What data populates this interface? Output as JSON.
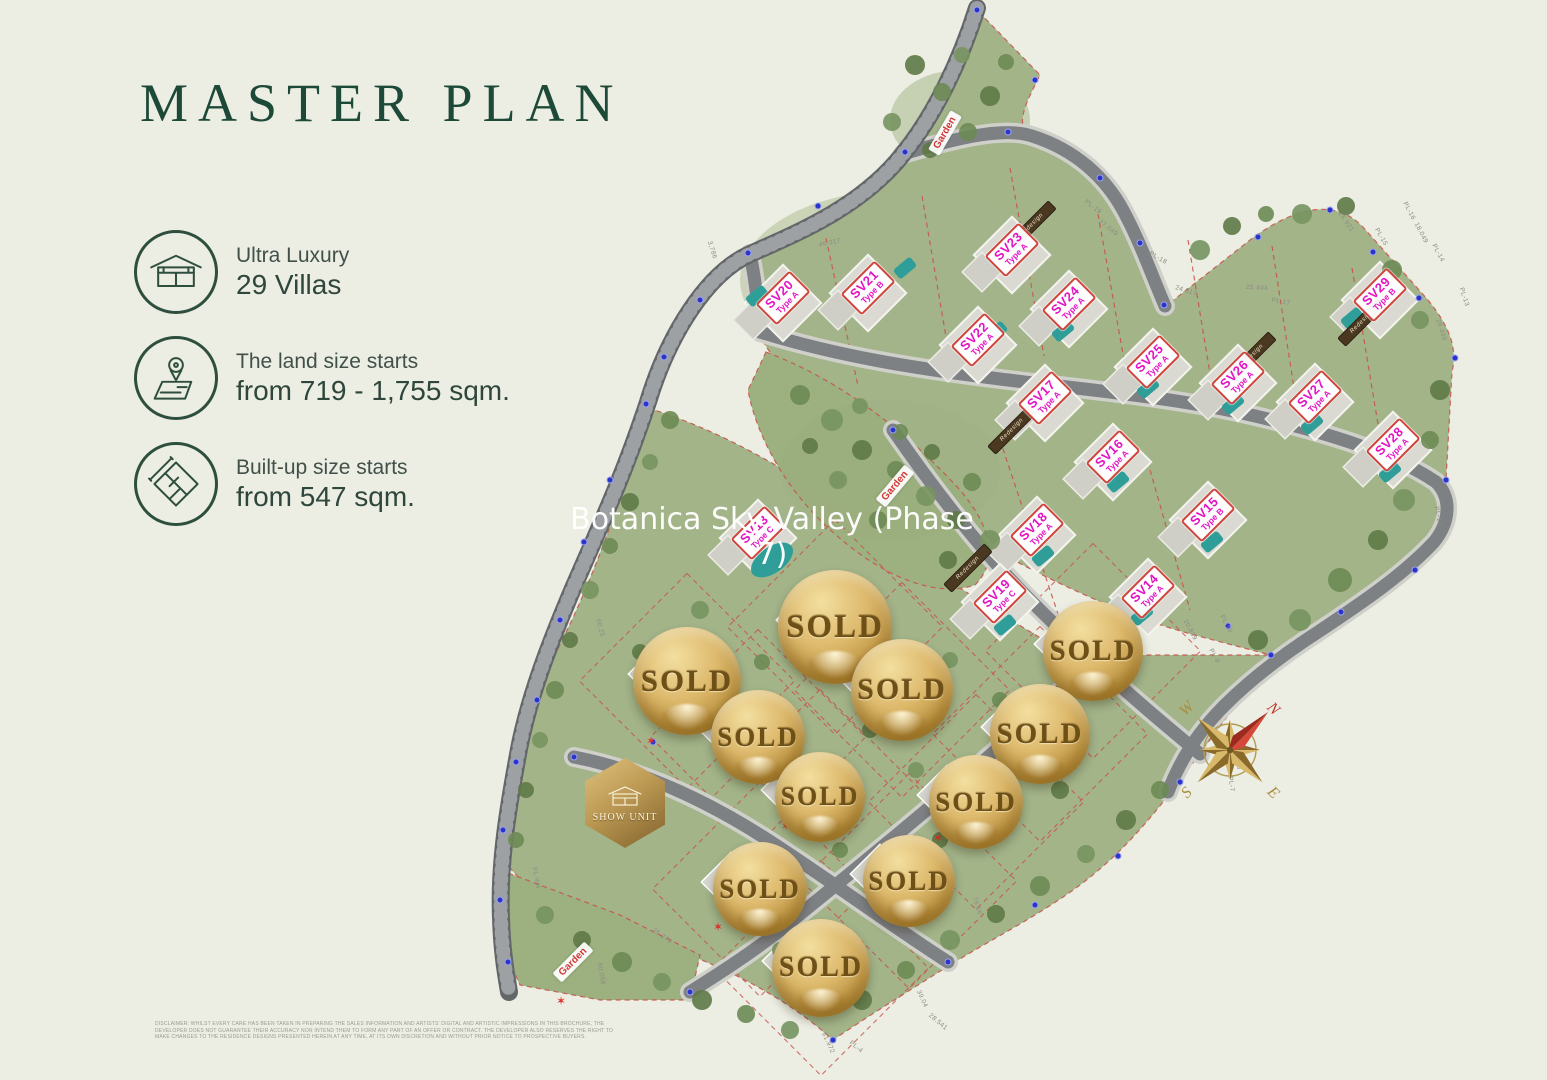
{
  "title": "MASTER PLAN",
  "colors": {
    "title_green": "#1d4a38",
    "villa_label_magenta": "#e414c4",
    "villa_label_border_red": "#d0453c",
    "sold_gold": "#caa24e",
    "garden_red": "#d23737",
    "terrain_green": "#a3b489",
    "background_beige": "#ecede3"
  },
  "legend": {
    "items": [
      {
        "icon": "villa-icon",
        "line1": "Ultra Luxury",
        "line2": "29 Villas"
      },
      {
        "icon": "land-size-icon",
        "line1": "The land size starts",
        "line2": "from 719 - 1,755 sqm."
      },
      {
        "icon": "built-up-icon",
        "line1": "Built-up size starts",
        "line2": "from 547 sqm."
      }
    ]
  },
  "watermark": {
    "line1": "Botanica Sky Valley (Phase",
    "line2": "7)"
  },
  "map": {
    "villa_labels": [
      {
        "id": "SV20",
        "type": "Type A",
        "x": 783,
        "y": 298,
        "rot": -45
      },
      {
        "id": "SV21",
        "type": "Type B",
        "x": 868,
        "y": 288,
        "rot": -45
      },
      {
        "id": "SV23",
        "type": "Type A",
        "x": 1012,
        "y": 250,
        "rot": -45
      },
      {
        "id": "SV22",
        "type": "Type A",
        "x": 978,
        "y": 340,
        "rot": -45
      },
      {
        "id": "SV24",
        "type": "Type A",
        "x": 1069,
        "y": 304,
        "rot": -45
      },
      {
        "id": "SV25",
        "type": "Type A",
        "x": 1153,
        "y": 362,
        "rot": -45
      },
      {
        "id": "SV26",
        "type": "Type A",
        "x": 1238,
        "y": 378,
        "rot": -45
      },
      {
        "id": "SV27",
        "type": "Type A",
        "x": 1315,
        "y": 397,
        "rot": -45
      },
      {
        "id": "SV28",
        "type": "Type A",
        "x": 1393,
        "y": 445,
        "rot": -45
      },
      {
        "id": "SV29",
        "type": "Type B",
        "x": 1380,
        "y": 295,
        "rot": -45
      },
      {
        "id": "SV17",
        "type": "Type A",
        "x": 1045,
        "y": 398,
        "rot": -45
      },
      {
        "id": "SV16",
        "type": "Type A",
        "x": 1113,
        "y": 457,
        "rot": -45
      },
      {
        "id": "SV15",
        "type": "Type B",
        "x": 1208,
        "y": 515,
        "rot": -45
      },
      {
        "id": "SV18",
        "type": "Type A",
        "x": 1037,
        "y": 530,
        "rot": -45
      },
      {
        "id": "SV19",
        "type": "Type C",
        "x": 1000,
        "y": 597,
        "rot": -45
      },
      {
        "id": "SV14",
        "type": "Type A",
        "x": 1148,
        "y": 592,
        "rot": -45
      },
      {
        "id": "SV13",
        "type": "Type C",
        "x": 758,
        "y": 533,
        "rot": -45
      }
    ],
    "sold_label": "SOLD",
    "sold_badges": [
      {
        "x": 835,
        "y": 627,
        "r": 57
      },
      {
        "x": 687,
        "y": 681,
        "r": 54
      },
      {
        "x": 902,
        "y": 690,
        "r": 51
      },
      {
        "x": 1093,
        "y": 651,
        "r": 50
      },
      {
        "x": 758,
        "y": 737,
        "r": 47
      },
      {
        "x": 1040,
        "y": 734,
        "r": 50
      },
      {
        "x": 820,
        "y": 797,
        "r": 45
      },
      {
        "x": 976,
        "y": 802,
        "r": 47
      },
      {
        "x": 760,
        "y": 889,
        "r": 47
      },
      {
        "x": 909,
        "y": 881,
        "r": 46
      },
      {
        "x": 821,
        "y": 968,
        "r": 49
      }
    ],
    "show_unit": {
      "label": "SHOW UNIT",
      "x": 625,
      "y": 803
    },
    "garden_labels": [
      {
        "text": "Garden",
        "x": 945,
        "y": 133,
        "rot": -60
      },
      {
        "text": "Garden",
        "x": 895,
        "y": 486,
        "rot": -50
      },
      {
        "text": "Garden",
        "x": 573,
        "y": 962,
        "rot": -45
      }
    ],
    "roof_labels": [
      {
        "text": "Redesign",
        "x": 1032,
        "y": 225,
        "rot": -45
      },
      {
        "text": "Redesign",
        "x": 1362,
        "y": 322,
        "rot": -45
      },
      {
        "text": "Redesign",
        "x": 1012,
        "y": 430,
        "rot": -45
      },
      {
        "text": "Redesign",
        "x": 968,
        "y": 568,
        "rot": -45
      },
      {
        "text": "Redesign",
        "x": 1252,
        "y": 356,
        "rot": -45
      }
    ],
    "survey_labels": [
      {
        "t": "46.317",
        "x": 830,
        "y": 243,
        "r": -12
      },
      {
        "t": "3,786",
        "x": 712,
        "y": 250,
        "r": 72
      },
      {
        "t": "PL-19",
        "x": 1093,
        "y": 207,
        "r": 38
      },
      {
        "t": "27.049",
        "x": 1108,
        "y": 228,
        "r": 38
      },
      {
        "t": "PL-18",
        "x": 1158,
        "y": 258,
        "r": 30
      },
      {
        "t": "24.817",
        "x": 1186,
        "y": 291,
        "r": 18
      },
      {
        "t": "25.494",
        "x": 1257,
        "y": 288,
        "r": 4
      },
      {
        "t": "PL-17",
        "x": 1281,
        "y": 302,
        "r": 10
      },
      {
        "t": "26.921",
        "x": 1346,
        "y": 222,
        "r": 55
      },
      {
        "t": "PL-16",
        "x": 1409,
        "y": 211,
        "r": 62
      },
      {
        "t": "PL-15",
        "x": 1381,
        "y": 237,
        "r": 60
      },
      {
        "t": "18.049",
        "x": 1421,
        "y": 233,
        "r": 62
      },
      {
        "t": "PL-14",
        "x": 1438,
        "y": 253,
        "r": 62
      },
      {
        "t": "29.439",
        "x": 1441,
        "y": 330,
        "r": 72
      },
      {
        "t": "PL-13",
        "x": 1464,
        "y": 297,
        "r": 72
      },
      {
        "t": "PL-12",
        "x": 1438,
        "y": 516,
        "r": 78
      },
      {
        "t": "20.839",
        "x": 1190,
        "y": 630,
        "r": 62
      },
      {
        "t": "PL-10",
        "x": 1226,
        "y": 624,
        "r": 62
      },
      {
        "t": "PL-9",
        "x": 1214,
        "y": 656,
        "r": 62
      },
      {
        "t": "PL-8",
        "x": 1238,
        "y": 762,
        "r": 82
      },
      {
        "t": "PL-7",
        "x": 1231,
        "y": 784,
        "r": 82
      },
      {
        "t": "60.25",
        "x": 600,
        "y": 628,
        "r": 75
      },
      {
        "t": "PL-W4",
        "x": 536,
        "y": 878,
        "r": 80
      },
      {
        "t": "25.279",
        "x": 662,
        "y": 936,
        "r": 35
      },
      {
        "t": "60.058",
        "x": 601,
        "y": 974,
        "r": 80
      },
      {
        "t": "76.56",
        "x": 977,
        "y": 906,
        "r": 72
      },
      {
        "t": "39.04",
        "x": 922,
        "y": 999,
        "r": 65
      },
      {
        "t": "28.541",
        "x": 938,
        "y": 1022,
        "r": 40
      },
      {
        "t": "61.972",
        "x": 828,
        "y": 1043,
        "r": 65
      },
      {
        "t": "PL-4",
        "x": 856,
        "y": 1047,
        "r": 40
      }
    ],
    "compass": {
      "n": "N",
      "e": "E",
      "s": "S",
      "w": "W"
    },
    "disclaimer": "DISCLAIMER: WHILST EVERY CARE HAS BEEN TAKEN IN PREPARING THE SALES INFORMATION AND ARTISTS' DIGITAL AND ARTISTIC IMPRESSIONS IN THIS BROCHURE, THE DEVELOPER DOES NOT GUARANTEE THEIR ACCURACY NOR INTEND THEM TO FORM ANY PART OF AN OFFER OR CONTRACT. THE DEVELOPER ALSO RESERVES THE RIGHT TO MAKE CHANGES TO THE RESIDENCE DESIGNS PRESENTED HEREIN AT ANY TIME, AT ITS OWN DISCRETION AND WITHOUT PRIOR NOTICE TO PROSPECTIVE BUYERS."
  }
}
